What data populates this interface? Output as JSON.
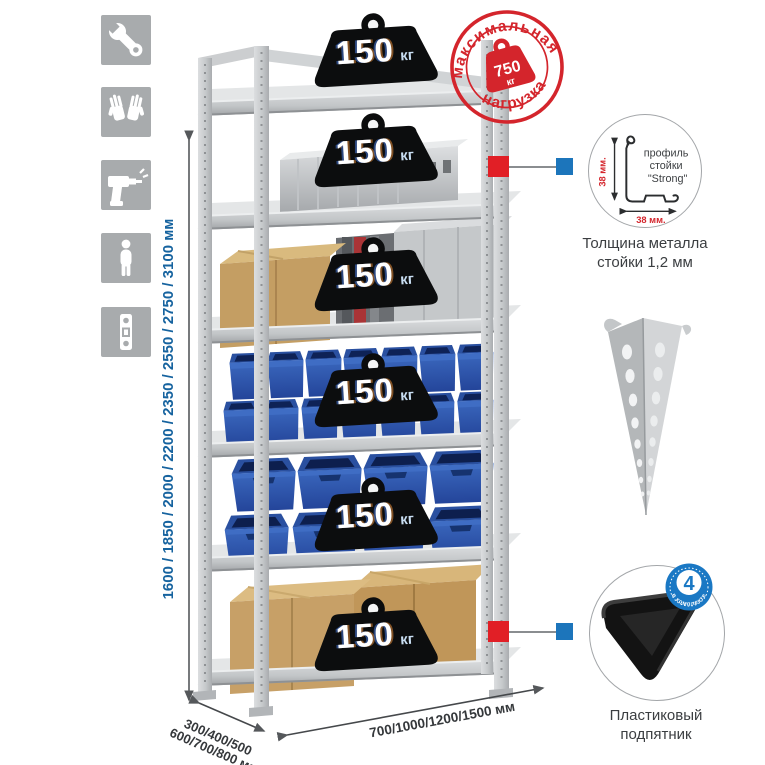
{
  "features": {
    "icons": [
      "wrench-icon",
      "gloves-icon",
      "drill-icon",
      "person-height-icon",
      "upright-profile-icon"
    ]
  },
  "dimensions": {
    "height_options": "1600 / 1850 / 2000 / 2200 / 2350 / 2550 / 2750 / 3100 мм",
    "depth_options_line1": "300/400/500",
    "depth_options_line2": "600/700/800 мм",
    "width_options": "700/1000/1200/1500 мм"
  },
  "max_load_stamp": {
    "arc_top": "максимальная",
    "arc_bottom": "нагрузка",
    "value": "750",
    "unit": "кг"
  },
  "rack": {
    "shelves": [
      {
        "load_value": "150",
        "load_unit": "кг"
      },
      {
        "load_value": "150",
        "load_unit": "кг"
      },
      {
        "load_value": "150",
        "load_unit": "кг"
      },
      {
        "load_value": "150",
        "load_unit": "кг"
      },
      {
        "load_value": "150",
        "load_unit": "кг"
      },
      {
        "load_value": "150",
        "load_unit": "кг"
      }
    ]
  },
  "profile_detail": {
    "line1": "профиль",
    "line2": "стойки",
    "line3": "\"Strong\"",
    "dim_vertical": "38 мм.",
    "dim_horizontal": "38 мм.",
    "caption": "Толщина металла стойки 1,2 мм"
  },
  "foot_detail": {
    "badge_value": "4",
    "badge_label": "в комплекте",
    "caption": "Пластиковый подпятник"
  },
  "colors": {
    "accent_red": "#d4252c",
    "accent_blue": "#1c75bb",
    "metal_gray": "#c9ccce",
    "bin_blue": "#2e55a3"
  }
}
